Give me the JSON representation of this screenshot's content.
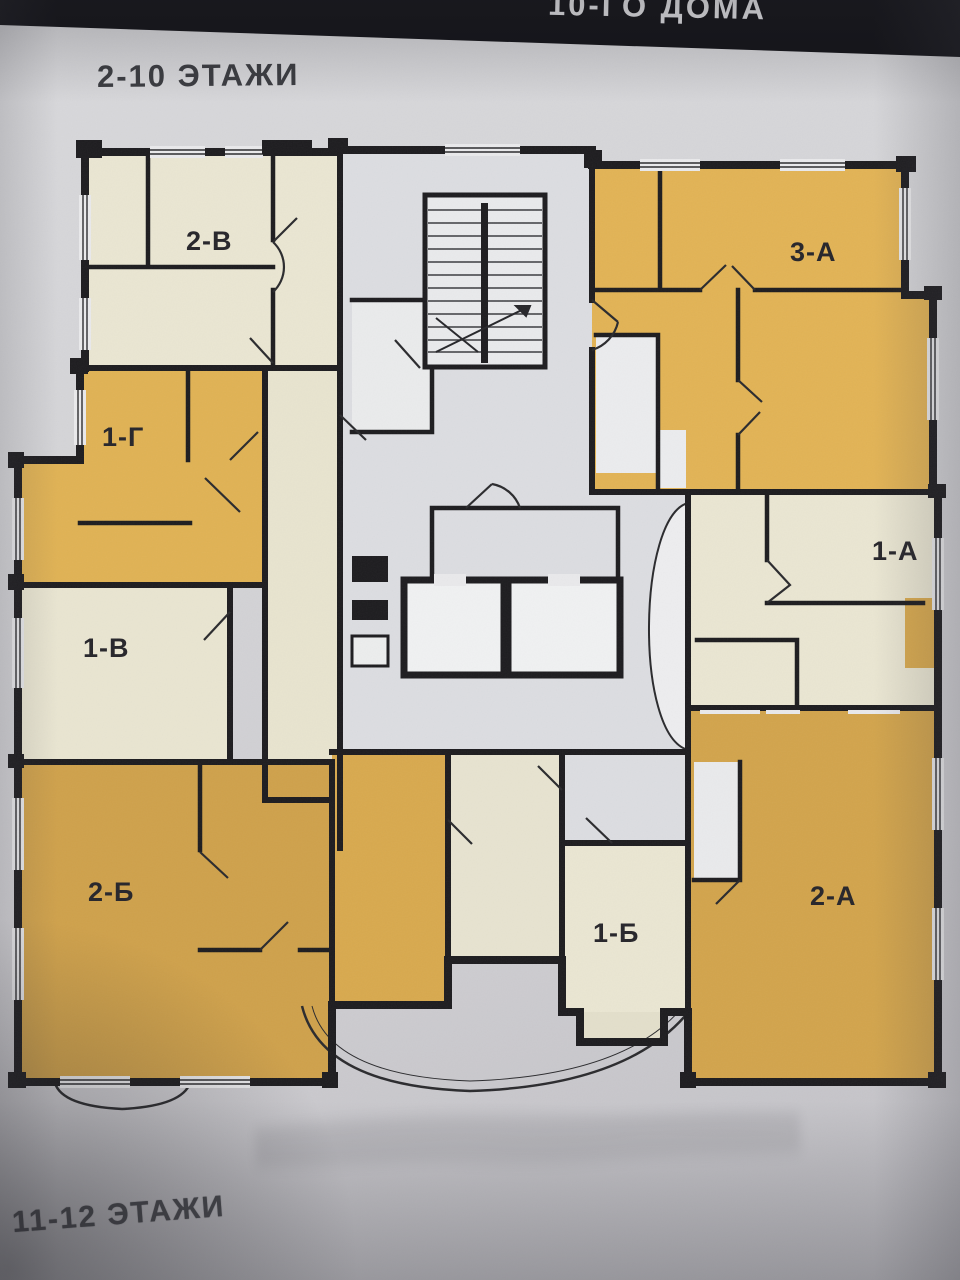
{
  "header": {
    "band_text_fragment": "10-ГО ДОМА"
  },
  "plan": {
    "floor_label_top": "2-10 ЭТАЖИ",
    "floor_label_bottom": "11-12 ЭТАЖИ",
    "apartments": [
      {
        "label": "2-В",
        "color_key": "cream"
      },
      {
        "label": "3-А",
        "color_key": "gold"
      },
      {
        "label": "1-Г",
        "color_key": "gold"
      },
      {
        "label": "1-А",
        "color_key": "cream"
      },
      {
        "label": "1-В",
        "color_key": "cream"
      },
      {
        "label": "2-Б",
        "color_key": "gold_dark"
      },
      {
        "label": "1-Б",
        "color_key": "cream"
      },
      {
        "label": "2-А",
        "color_key": "gold_dark"
      }
    ],
    "colors": {
      "wall": "#1d1c1f",
      "cream": "#eae6d2",
      "gold": "#e2b355",
      "gold_dark": "#cfa14b",
      "core_gray": "#dcdde1",
      "paper": "#d4d4d7",
      "header_band": "#131318"
    }
  }
}
